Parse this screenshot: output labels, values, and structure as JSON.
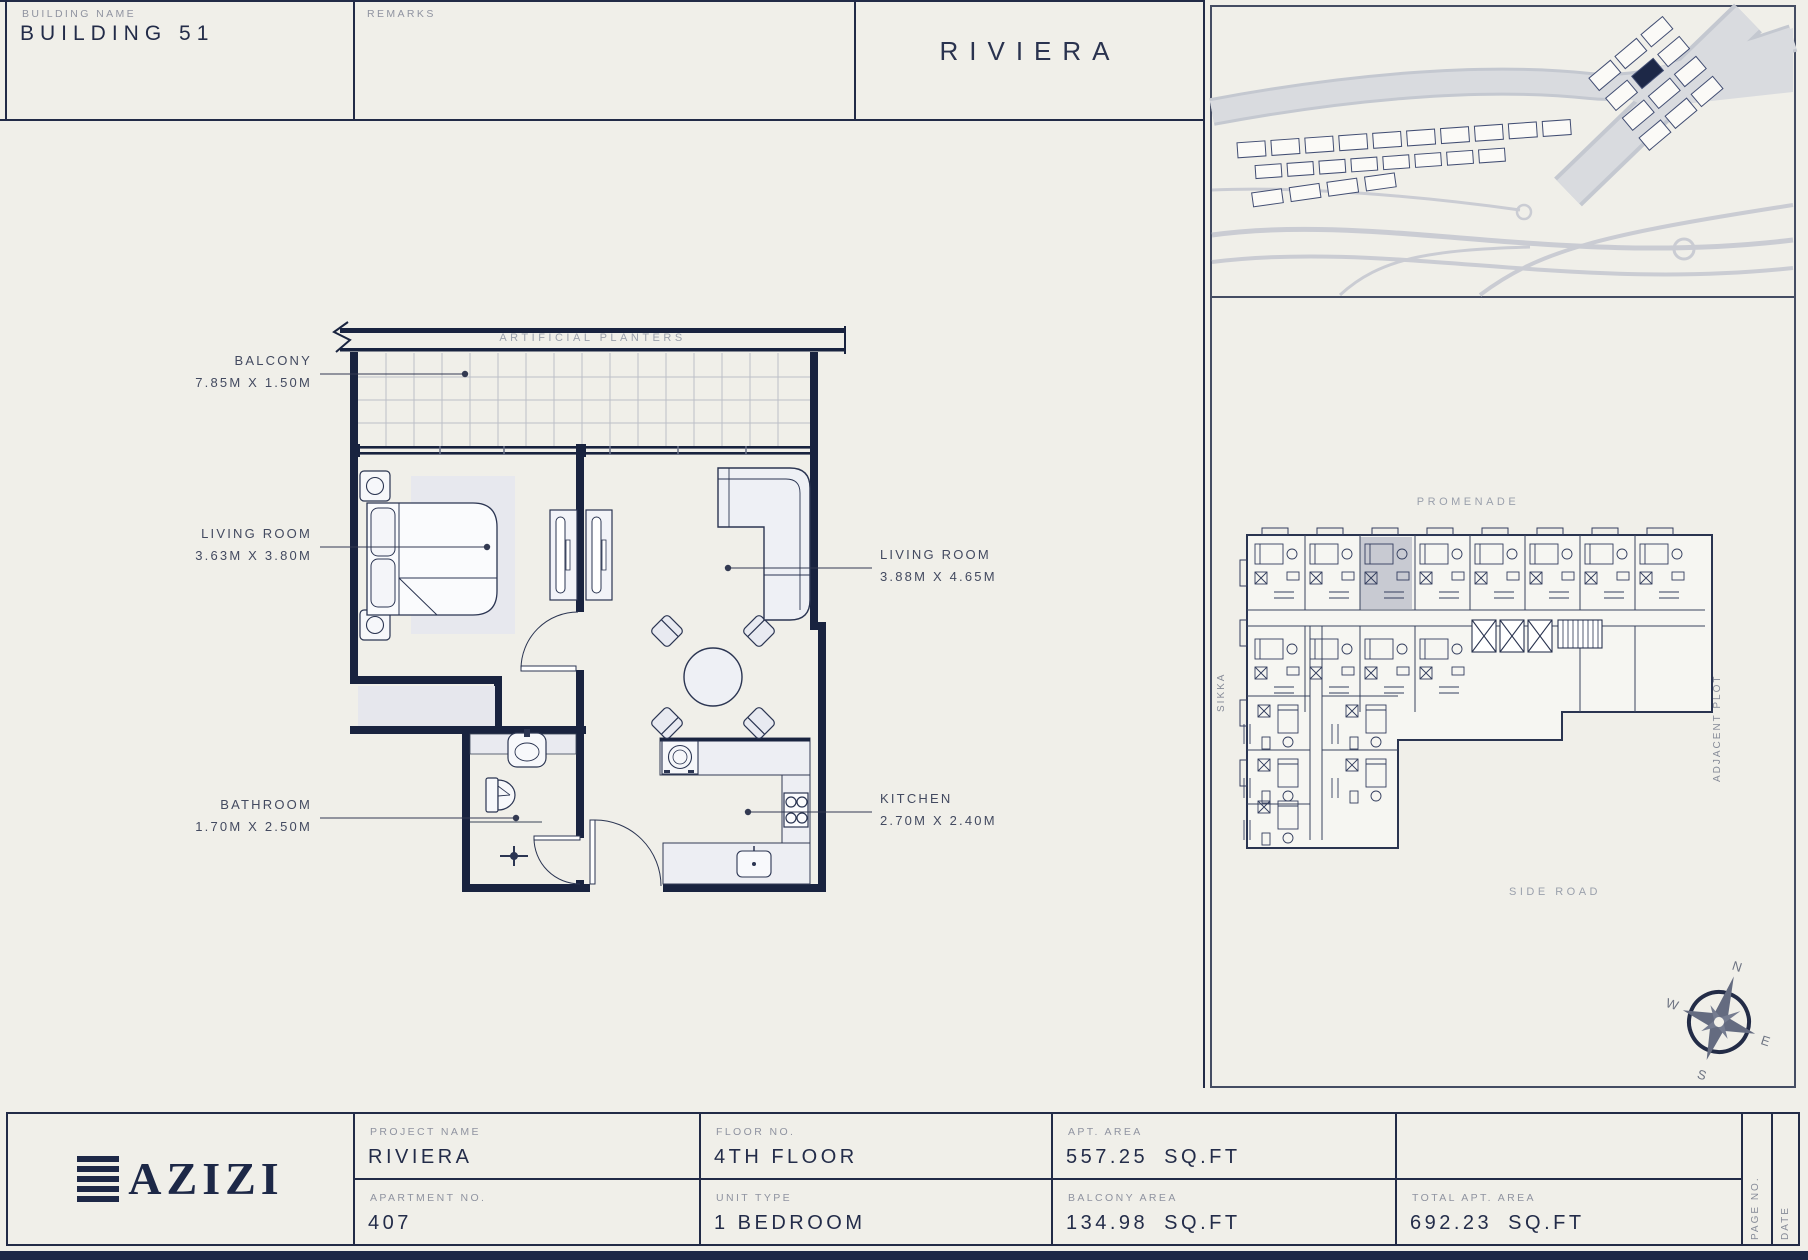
{
  "header": {
    "building_name_label": "BUILDING NAME",
    "building_name": "BUILDING 51",
    "remarks_label": "REMARKS",
    "project_title": "RIVIERA"
  },
  "floor_plan": {
    "planter_label": "ARTIFICIAL PLANTERS",
    "labels": {
      "balcony": {
        "name": "BALCONY",
        "dims": "7.85M X 1.50M"
      },
      "bedroom": {
        "name": "LIVING ROOM",
        "dims": "3.63M X 3.80M"
      },
      "living": {
        "name": "LIVING ROOM",
        "dims": "3.88M X 4.65M"
      },
      "bathroom": {
        "name": "BATHROOM",
        "dims": "1.70M X 2.50M"
      },
      "kitchen": {
        "name": "KITCHEN",
        "dims": "2.70M X 2.40M"
      }
    }
  },
  "key_plan": {
    "promenade": "PROMENADE",
    "sikka": "SIKKA",
    "adjacent_plot": "ADJACENT PLOT",
    "side_road": "SIDE ROAD",
    "compass": {
      "n": "N",
      "e": "E",
      "s": "S",
      "w": "W"
    }
  },
  "title_block": {
    "brand": "AZIZI",
    "project_name": {
      "label": "PROJECT NAME",
      "value": "RIVIERA"
    },
    "apartment_no": {
      "label": "APARTMENT NO.",
      "value": "407"
    },
    "floor_no": {
      "label": "FLOOR NO.",
      "value": "4TH FLOOR"
    },
    "unit_type": {
      "label": "UNIT TYPE",
      "value": "1 BEDROOM"
    },
    "apt_area": {
      "label": "APT. AREA",
      "value": "557.25",
      "unit": "SQ.FT"
    },
    "balcony_area": {
      "label": "BALCONY AREA",
      "value": "134.98",
      "unit": "SQ.FT"
    },
    "total_area": {
      "label": "TOTAL APT. AREA",
      "value": "692.23",
      "unit": "SQ.FT"
    },
    "page_no_label": "PAGE NO.",
    "date_label": "DATE"
  },
  "colors": {
    "background": "#f0efe9",
    "wall_navy": "#19233f",
    "line_navy": "#2b3552",
    "label_gray": "#8f93a0",
    "highlight_unit": "#c8cad2",
    "footer_bar": "#1d2847"
  }
}
